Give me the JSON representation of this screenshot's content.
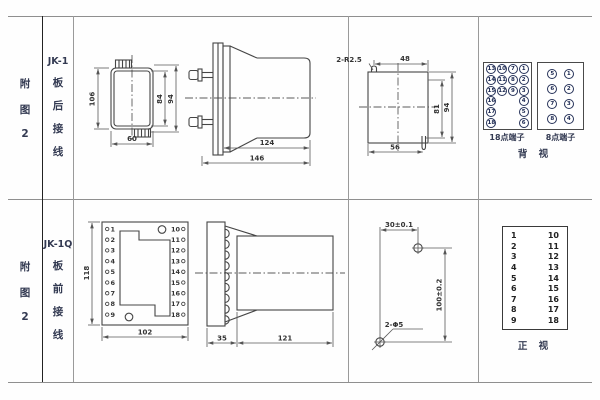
{
  "figure": {
    "fig": [
      "附",
      "图",
      "2"
    ]
  },
  "rear": {
    "model": [
      "JK-1",
      "板",
      "后",
      "接",
      "线"
    ],
    "back": {
      "h": "106",
      "w": "60",
      "h_in": "84",
      "h_out": "94"
    },
    "side": {
      "body": "124",
      "total": "146"
    },
    "cutout": {
      "note": "2-R2.5",
      "top": "48",
      "h_in": "81",
      "h_out": "94",
      "bottom": "56"
    },
    "t18": {
      "label": "18点端子",
      "c1": [
        "13",
        "14",
        "15",
        "16",
        "17",
        "18"
      ],
      "c2": [
        "10",
        "11",
        "12"
      ],
      "c3": [
        "7",
        "8",
        "9"
      ],
      "c4": [
        "1",
        "2",
        "3",
        "4",
        "5",
        "6"
      ]
    },
    "t8": {
      "label": "8点端子",
      "l": [
        "5",
        "6",
        "7",
        "8"
      ],
      "r": [
        "1",
        "2",
        "3",
        "4"
      ]
    },
    "view": "背 视"
  },
  "front": {
    "model": [
      "JK-1Q",
      "板",
      "前",
      "接",
      "线"
    ],
    "plate": {
      "h": "118",
      "w": "102"
    },
    "left": [
      "1",
      "2",
      "3",
      "4",
      "5",
      "6",
      "7",
      "8",
      "9"
    ],
    "right": [
      "10",
      "11",
      "12",
      "13",
      "14",
      "15",
      "16",
      "17",
      "18"
    ],
    "side": {
      "front": "35",
      "body": "121"
    },
    "drill": {
      "dx": "30±0.1",
      "dy": "100±0.2",
      "holes": "2-Φ5"
    },
    "tbl": {
      "l": [
        "1",
        "2",
        "3",
        "4",
        "5",
        "6",
        "7",
        "8",
        "9"
      ],
      "r": [
        "10",
        "11",
        "12",
        "13",
        "14",
        "15",
        "16",
        "17",
        "18"
      ]
    },
    "view": "正 视"
  }
}
